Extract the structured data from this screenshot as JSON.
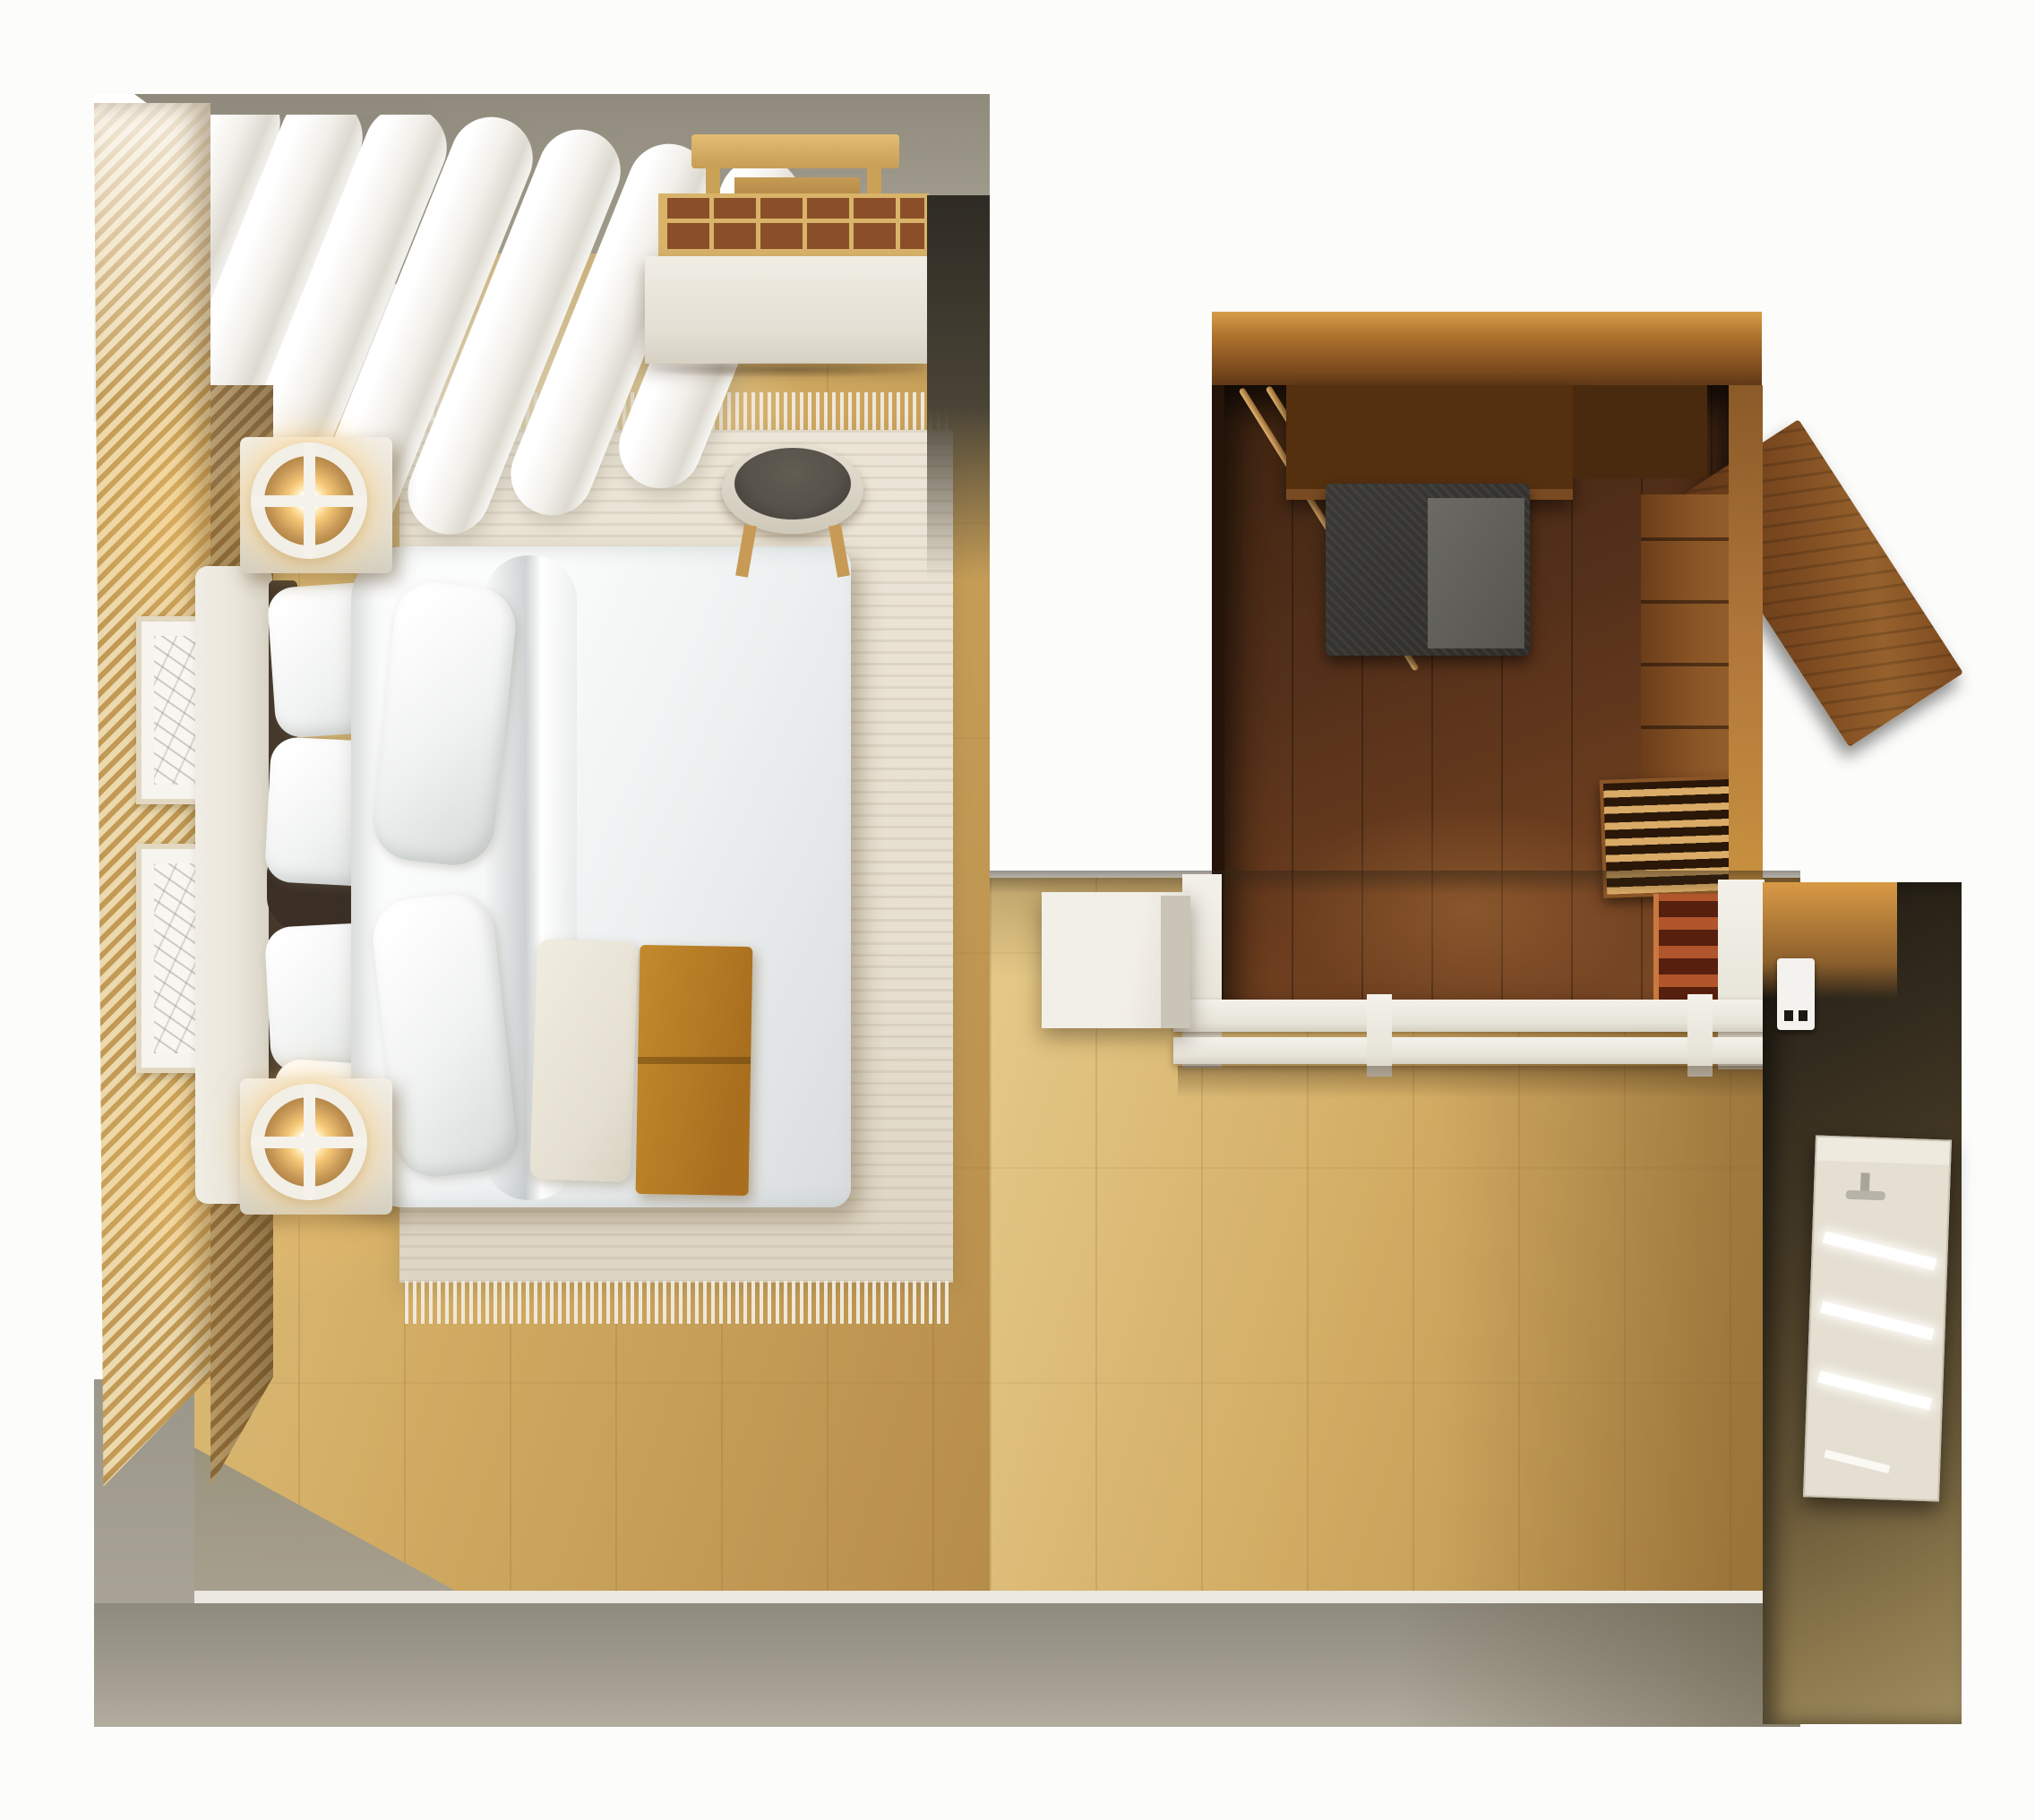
{
  "scene": {
    "kind": "top-down 3D interior render, no visible text",
    "rooms": [
      {
        "name": "bedroom",
        "objects": [
          "vertical-slat accent wall",
          "window with sheer curtain folds",
          "double bed with white duvet",
          "four white pillows",
          "two large leaning pillows",
          "cream upholstered headboard",
          "two white nightstands",
          "two glowing ring table lamps",
          "cream area rug with fringed ends",
          "two framed botanical sketches",
          "white desk with wooden desk organizer",
          "wooden laptop stand",
          "stool with dark seat and wooden legs",
          "white bench cushion at foot of bed",
          "mustard folded throw blanket",
          "light oak plank flooring"
        ]
      },
      {
        "name": "walk-in-closet",
        "objects": [
          "dark walnut plank flooring",
          "two wooden hanging rods",
          "overhead wooden shelf",
          "dark woven storage basket with gray cloth",
          "leaning angled wooden panel",
          "wooden drawer unit along right wall",
          "slatted-top wooden dresser",
          "red-toned shelf stack",
          "white sliding-door partition with tracks",
          "small white cabinet outside partition",
          "wall switch with two buttons"
        ]
      },
      {
        "name": "perimeter",
        "objects": [
          "olive-gray walls seen from above",
          "white baseboard",
          "right wall in deep shadow",
          "panel radiator with three glowing slots and valve"
        ]
      }
    ]
  },
  "colors": {
    "pageBg": "#fcfcfb",
    "wallOlive": "#8f8a7c",
    "wallOliveLight": "#a8a394",
    "floorOakLight": "#e6cb8b",
    "floorOak": "#d2ac63",
    "floorOakDeep": "#b68c49",
    "slatWood": "#c29a55",
    "slatCream": "#ecd9ae",
    "rug": "#e7dfd0",
    "rugFringe": "#efe8d9",
    "linenWhite": "#f0f2f1",
    "linenShadow": "#dadedd",
    "headboard": "#e9e5da",
    "ochreThrow": "#c48a2c",
    "lampGlow": "#f5c877",
    "lampWood": "#c89a58",
    "deskWhite": "#e3dfd3",
    "organizerWood": "#d9b36a",
    "organizerCell": "#8a4f28",
    "chairSeat": "#57524a",
    "closetFrame": "#b0762f",
    "closetFloorDark": "#3f2512",
    "closetFloorLight": "#7c4a26",
    "basket": "#33322e",
    "basketCloth": "#6b6a64",
    "woodFurniture": "#8a5526",
    "woodLit": "#c8913f",
    "redShelf": "#b0552c",
    "partitionWhite": "#e7e4d9",
    "rightWallDark": "#201b13",
    "rightWallLight": "#9e8c5e",
    "radiator": "#e5dfd2"
  }
}
